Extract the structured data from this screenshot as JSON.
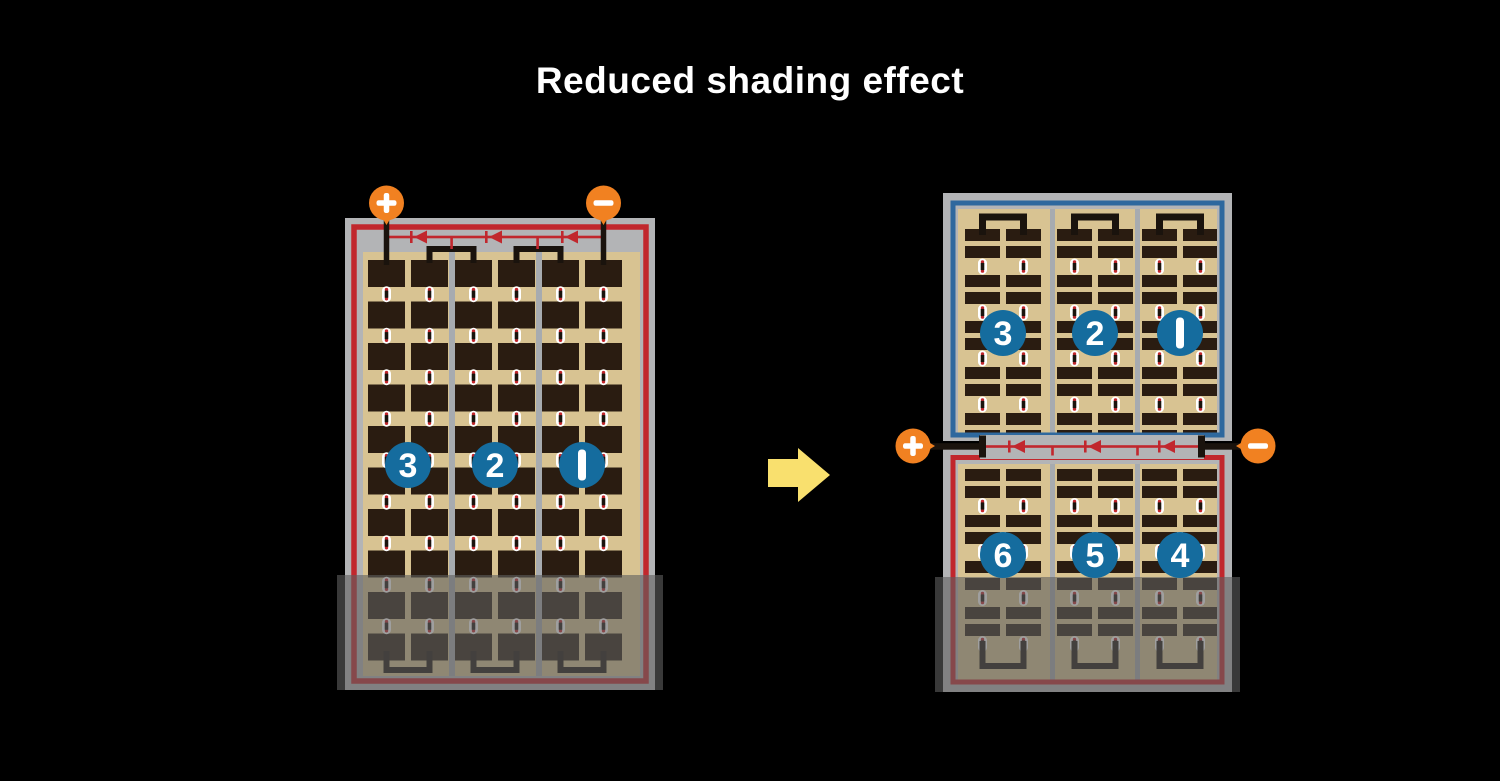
{
  "title": "Reduced shading effect",
  "colors": {
    "background": "#000000",
    "frame_gray": "#B3B4B6",
    "cell_background_tan": "#D8C392",
    "cell_dark": "#2A1C11",
    "divider_gray": "#A7ABB0",
    "circuit_red": "#C1272D",
    "border_blue": "#2E689E",
    "badge_blue": "#156C9E",
    "terminal_orange": "#F18121",
    "arrow_yellow": "#F9E06E",
    "wire_black": "#1A130D",
    "connector_white": "#FFFFFF",
    "shade_overlay": "rgba(95,95,95,0.6)"
  },
  "left_module": {
    "terminals": [
      {
        "label": "+"
      },
      {
        "label": "−"
      }
    ],
    "string_badges": [
      {
        "label": "3"
      },
      {
        "label": "2"
      },
      {
        "label": "1"
      }
    ],
    "bypass_diodes": 3,
    "cell_rows": 10,
    "cell_columns": 6,
    "shaded_bottom": true
  },
  "arrow": {
    "direction": "right"
  },
  "right_module": {
    "terminals": [
      {
        "label": "+"
      },
      {
        "label": "−"
      }
    ],
    "top_half": {
      "border_color": "blue",
      "string_badges": [
        {
          "label": "3"
        },
        {
          "label": "2"
        },
        {
          "label": "1"
        }
      ],
      "shaded": false
    },
    "bottom_half": {
      "border_color": "red",
      "string_badges": [
        {
          "label": "6"
        },
        {
          "label": "5"
        },
        {
          "label": "4"
        }
      ],
      "shaded": true
    },
    "bypass_diodes": 3
  }
}
